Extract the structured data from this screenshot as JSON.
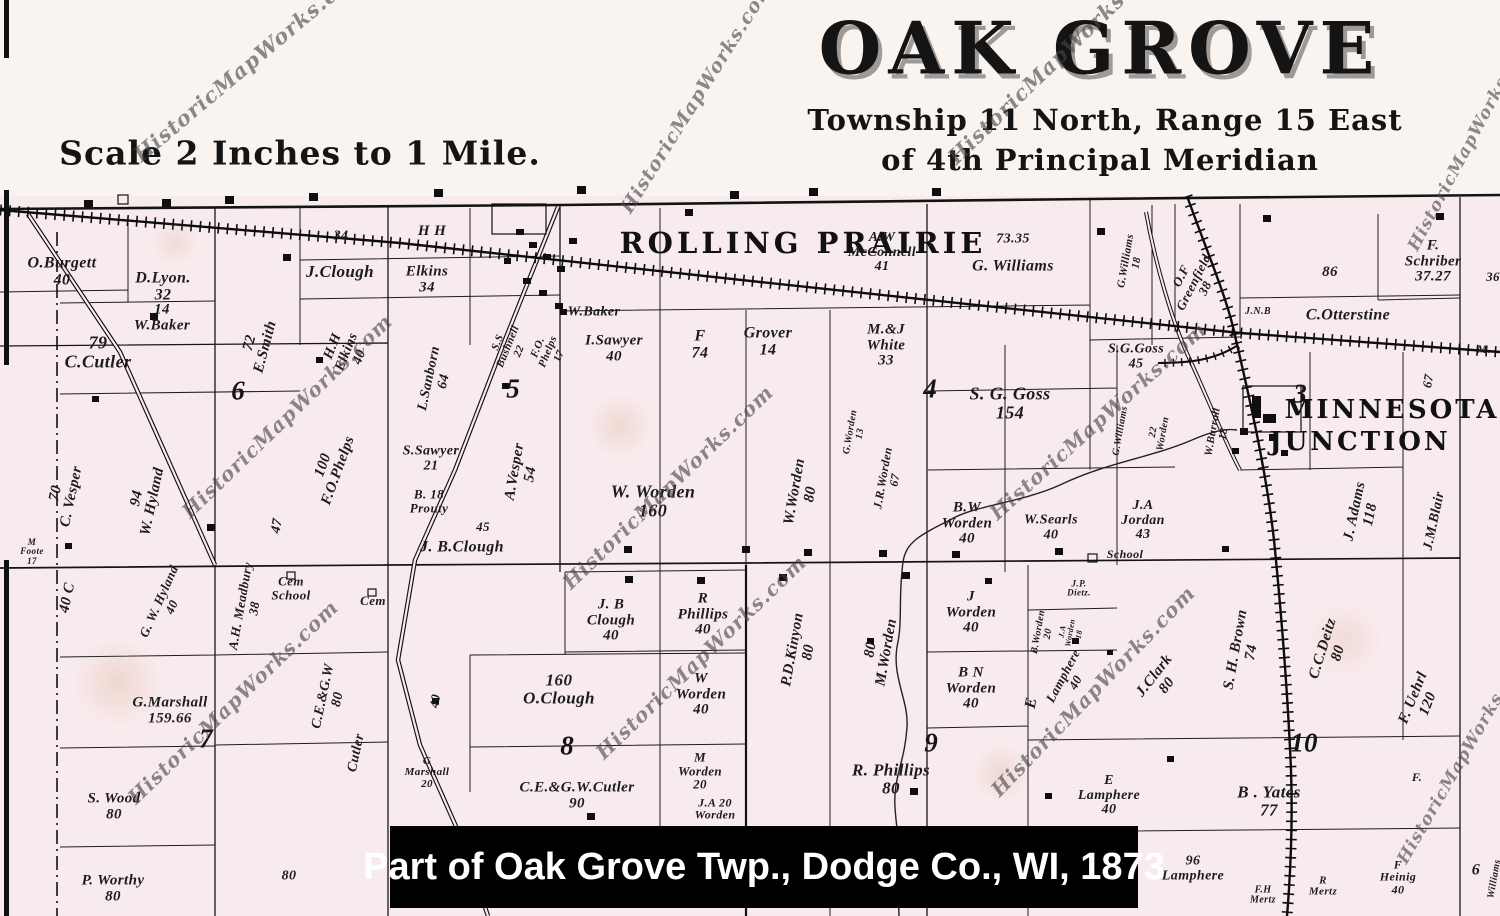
{
  "header": {
    "title": "OAK GROVE",
    "subtitle_line1": "Township 11 North, Range 15 East",
    "subtitle_line2": "of 4th Principal Meridian",
    "scale_note": "Scale 2 Inches to 1 Mile."
  },
  "caption": "Part of Oak Grove Twp., Dodge Co., WI, 1873",
  "watermark": {
    "text": "HistoricMapWorks.com"
  },
  "towns": {
    "rolling_prairie": "ROLLING PRAIRIE",
    "minnesota_junction_line1": "MINNESOTA",
    "minnesota_junction_line2": "JUNCTION"
  },
  "sections": [
    "6",
    "5",
    "4",
    "3",
    "7",
    "8",
    "9",
    "10"
  ],
  "parcels": [
    "O.Burgett\n40",
    "D.Lyon.\n32",
    "14\nW.Baker",
    "79\nC.Cutler",
    "72\nE.Smith",
    "H.H\nElkins\n40",
    "J.Clough",
    "Elkins\n34",
    "34",
    "H H",
    "L.Sanborn\n64",
    "S.S\nBushnell\n22",
    "F.O.\nPhelps\n17",
    "W.Baker",
    "I.Sawyer\n40",
    "F\n74",
    "Grover\n14",
    "M.&J\nWhite\n33",
    "A.W\nMcConnell\n41",
    "73.35",
    "G. Williams",
    "G.Williams\n18",
    "O.F\nGreenfield\n38",
    "86",
    "F. Schriber\n37.27",
    "36",
    "C.Otterstine",
    "J.N.B",
    "S.G.Goss\n45",
    "S. G. Goss\n154",
    "G.Williams",
    "22\nWorden",
    "W.Burrall\n18",
    "M.",
    "70\nC. Vesper",
    "94\nW. Hyland",
    "40   C",
    "M\nFoote\n17",
    "A.H. Meadbury\n38",
    "47",
    "Cem\nSchool",
    "Cem",
    "100\nF.O.Phelps",
    "S.Sawyer\n21",
    "B. 18\nProuty",
    "A.Vesper\n54",
    "45",
    "J. B.Clough",
    "W. Worden\n160",
    "J. B\nClough\n40",
    "R\nPhillips\n40",
    "W\nWorden\n40",
    "160\nO.Clough",
    "C.E.&G.W.Cutler\n90",
    "G\nMarshall\n20",
    "40",
    "C.E.&G.W\n80",
    "Cutler",
    "G.Marshall\n159.66",
    "S. Wood\n80",
    "P. Worthy\n80",
    "80",
    "G. W. Hyland\n40",
    "P.D.Kinyon\n80",
    "80\nM.Worden",
    "J\nWorden\n40",
    "J.P.\nDietz.",
    "B.Worden\n20",
    "J.A\nWorden\n18",
    "B N\nWorden\n40",
    "E",
    "Lamphere\n40",
    "J.Clark\n80",
    "S. H. Brown\n74",
    "C.C.Deitz\n80",
    "F. Uehrl\n120",
    "J. Adams\n118",
    "J.M.Blair",
    "67",
    "M\nWorden\n20",
    "J.A 20\nWorden",
    "R.  Phillips\n80",
    "School",
    "E\nLamphere\n40",
    "B .   Yates\n77",
    "96\nLamphere",
    "F.H\nMertz",
    "R\nMertz",
    "F\nHeinig\n40",
    "F.",
    "6",
    "Williams",
    "W.Worden\n80",
    "G.Worden\n13",
    "J.R.Worden\n67",
    "B.W\nWorden\n40",
    "W.Searls\n40",
    "J.A\nJordan\n43"
  ],
  "colors": {
    "paper": "#faf4f0",
    "map_pink": "#f8ebee",
    "ink": "#1c1c1c",
    "caption_bg": "#000000",
    "caption_text": "#ffffff",
    "watermark": "#464646"
  }
}
